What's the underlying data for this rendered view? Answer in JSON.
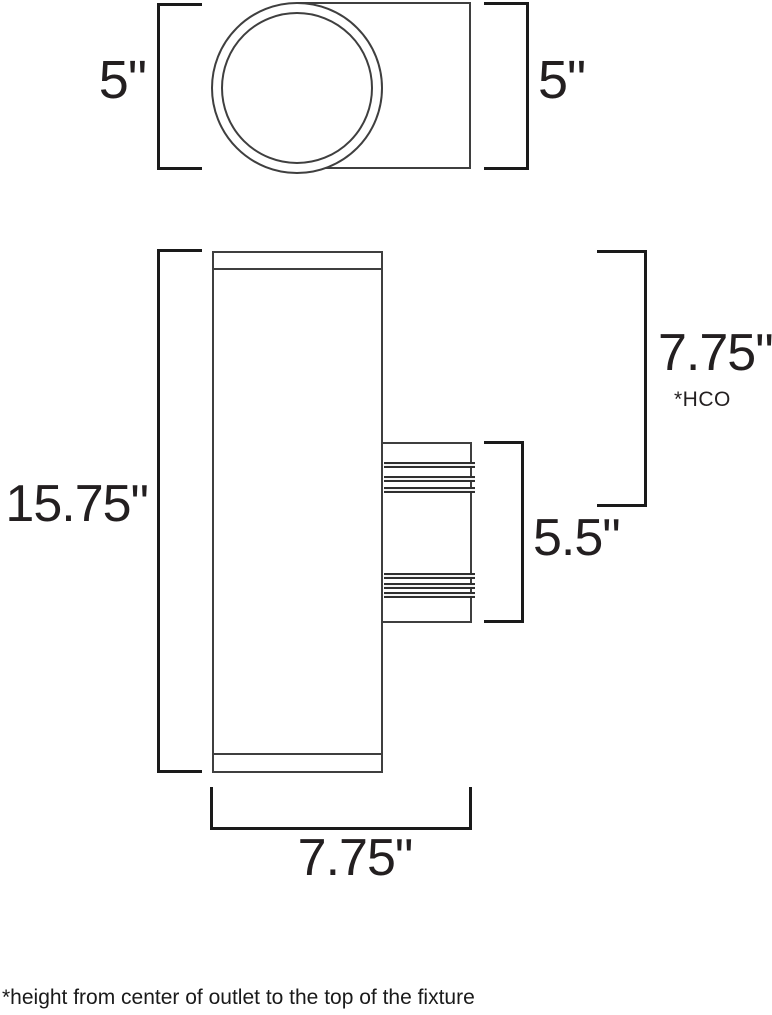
{
  "drawing_title": "wall sconce cylinder fixture dimension diagram",
  "colors": {
    "background": "#ffffff",
    "outline_line": "#3f3f3f",
    "dimension_bracket": "#1a1a1a",
    "text": "#231f20"
  },
  "top_view": {
    "dim_left": "5\"",
    "dim_right": "5\""
  },
  "front_view": {
    "dim_height": "15.75\"",
    "dim_hco": "7.75\"",
    "dim_hco_note": "*HCO",
    "dim_mount_height": "5.5\"",
    "dim_width": "7.75\""
  },
  "footnote": "*height from center of outlet to the top of the fixture"
}
